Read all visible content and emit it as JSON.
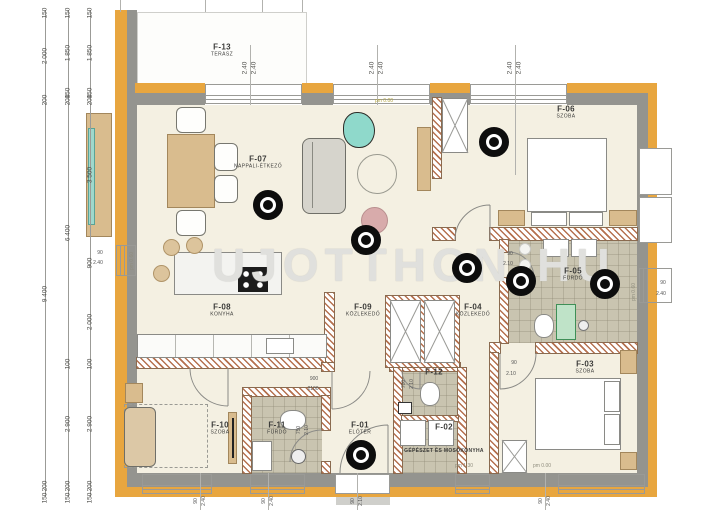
{
  "watermark": {
    "left": "UJOTTHON",
    "right": "HU"
  },
  "rooms": [
    {
      "id": "F-13",
      "sub": "TERASZ",
      "x": 222,
      "y": 46
    },
    {
      "id": "F-07",
      "sub": "NAPPALI-ÉTKEZŐ",
      "x": 258,
      "y": 158
    },
    {
      "id": "F-06",
      "sub": "SZOBA",
      "x": 566,
      "y": 108
    },
    {
      "id": "F-08",
      "sub": "KONYHA",
      "x": 222,
      "y": 306
    },
    {
      "id": "F-09",
      "sub": "KÖZLEKEDŐ",
      "x": 363,
      "y": 306
    },
    {
      "id": "F-04",
      "sub": "KÖZLEKEDŐ",
      "x": 473,
      "y": 306
    },
    {
      "id": "F-05",
      "sub": "FÜRDŐ",
      "x": 573,
      "y": 270
    },
    {
      "id": "F-03",
      "sub": "SZOBA",
      "x": 585,
      "y": 363
    },
    {
      "id": "F-10",
      "sub": "SZOBA",
      "x": 220,
      "y": 424
    },
    {
      "id": "F-11",
      "sub": "FÜRDŐ",
      "x": 277,
      "y": 424
    },
    {
      "id": "F-01",
      "sub": "ELŐTÉR",
      "x": 360,
      "y": 424
    },
    {
      "id": "F-12",
      "sub": "",
      "x": 434,
      "y": 372
    },
    {
      "id": "F-02",
      "sub": "",
      "x": 444,
      "y": 427
    }
  ],
  "room_f02_name": "GÉPÉSZET ÉS MOSÓKONYHA",
  "markers": [
    {
      "x": 268,
      "y": 205
    },
    {
      "x": 366,
      "y": 240
    },
    {
      "x": 494,
      "y": 142
    },
    {
      "x": 467,
      "y": 268
    },
    {
      "x": 521,
      "y": 281
    },
    {
      "x": 605,
      "y": 284
    },
    {
      "x": 361,
      "y": 455
    }
  ],
  "dim_columns": [
    {
      "x": 45,
      "labels": [
        [
          "150",
          13
        ],
        [
          "2 000",
          56
        ],
        [
          "200",
          100
        ],
        [
          "9 400",
          294
        ],
        [
          "200",
          486
        ],
        [
          "150",
          498
        ]
      ]
    },
    {
      "x": 68,
      "labels": [
        [
          "150",
          13
        ],
        [
          "1 850",
          53
        ],
        [
          "150",
          93
        ],
        [
          "200",
          100
        ],
        [
          "6 400",
          233
        ],
        [
          "100",
          364
        ],
        [
          "2 900",
          424
        ],
        [
          "200",
          486
        ],
        [
          "150",
          498
        ]
      ]
    },
    {
      "x": 90,
      "labels": [
        [
          "150",
          13
        ],
        [
          "1 850",
          53
        ],
        [
          "150",
          93
        ],
        [
          "200",
          100
        ],
        [
          "3 500",
          175
        ],
        [
          "900",
          263
        ],
        [
          "2 000",
          322
        ],
        [
          "100",
          364
        ],
        [
          "2 900",
          424
        ],
        [
          "200",
          486
        ],
        [
          "150",
          498
        ]
      ]
    }
  ],
  "head_labels": [
    {
      "x": 250,
      "a": "2.40",
      "b": "2.40"
    },
    {
      "x": 377,
      "a": "2.40",
      "b": "2.40"
    },
    {
      "x": 515,
      "a": "2.40",
      "b": "2.40"
    }
  ],
  "sill_labels": [
    {
      "x": 200,
      "a": "90",
      "b": "2.40"
    },
    {
      "x": 268,
      "a": "90",
      "b": "2.40"
    },
    {
      "x": 357,
      "a": "90",
      "b": "2.10"
    },
    {
      "x": 545,
      "a": "90",
      "b": "2.40"
    }
  ],
  "spec_labels": [
    {
      "x": 100,
      "y": 253,
      "t": "90",
      "rot": false
    },
    {
      "x": 98,
      "y": 263,
      "t": "2.40",
      "rot": false
    },
    {
      "x": 663,
      "y": 283,
      "t": "90",
      "rot": false
    },
    {
      "x": 661,
      "y": 294,
      "t": "2.40",
      "rot": false
    },
    {
      "x": 510,
      "y": 254,
      "t": "90",
      "rot": false
    },
    {
      "x": 508,
      "y": 264,
      "t": "2.10",
      "rot": false
    },
    {
      "x": 514,
      "y": 363,
      "t": "90",
      "rot": false
    },
    {
      "x": 511,
      "y": 374,
      "t": "2.10",
      "rot": false
    },
    {
      "x": 314,
      "y": 379,
      "t": "900",
      "rot": false
    },
    {
      "x": 313,
      "y": 389,
      "t": "2100",
      "rot": false
    },
    {
      "x": 404,
      "y": 384,
      "t": "700",
      "rot": true
    },
    {
      "x": 412,
      "y": 384,
      "t": "2.10",
      "rot": true
    },
    {
      "x": 299,
      "y": 430,
      "t": "750",
      "rot": true
    },
    {
      "x": 307,
      "y": 430,
      "t": "2.10",
      "rot": true
    }
  ],
  "level_labels": [
    {
      "x": 384,
      "y": 101,
      "t": "pm 0.00",
      "color": "#b3a43e",
      "rot": false
    },
    {
      "x": 464,
      "y": 466,
      "t": "pm 1.30",
      "color": "#8f8d7e",
      "rot": false
    },
    {
      "x": 542,
      "y": 466,
      "t": "pm 0.00",
      "color": "#8f8d7e",
      "rot": false
    },
    {
      "x": 132,
      "y": 261,
      "t": "pm 0.60",
      "color": "#8f8d7e",
      "rot": true
    },
    {
      "x": 634,
      "y": 292,
      "t": "pm 0.60",
      "color": "#8f8d7e",
      "rot": true
    }
  ]
}
